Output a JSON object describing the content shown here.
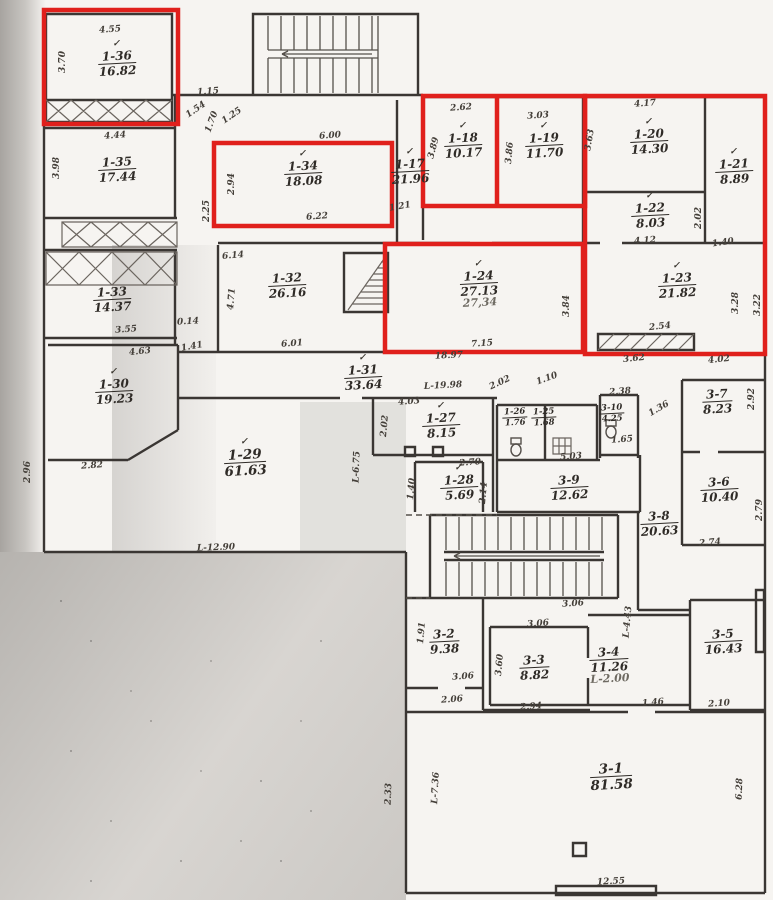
{
  "plan": {
    "highlight_color": "#e0201c",
    "rooms": [
      {
        "id": "1-36",
        "area": "16.82",
        "check": "✓",
        "note": ""
      },
      {
        "id": "1-35",
        "area": "17.44",
        "check": "",
        "note": ""
      },
      {
        "id": "1-33",
        "area": "14.37",
        "check": "",
        "note": ""
      },
      {
        "id": "1-30",
        "area": "19.23",
        "check": "✓",
        "note": ""
      },
      {
        "id": "1-34",
        "area": "18.08",
        "check": "✓",
        "note": ""
      },
      {
        "id": "1-17",
        "area": "21.96",
        "check": "✓",
        "note": ""
      },
      {
        "id": "1-18",
        "area": "10.17",
        "check": "✓",
        "note": ""
      },
      {
        "id": "1-19",
        "area": "11.70",
        "check": "✓",
        "note": ""
      },
      {
        "id": "1-20",
        "area": "14.30",
        "check": "✓",
        "note": ""
      },
      {
        "id": "1-21",
        "area": "8.89",
        "check": "✓",
        "note": ""
      },
      {
        "id": "1-22",
        "area": "8.03",
        "check": "✓",
        "note": ""
      },
      {
        "id": "1-24",
        "area": "27.13",
        "check": "✓",
        "note": "27,34"
      },
      {
        "id": "1-23",
        "area": "21.82",
        "check": "✓",
        "note": ""
      },
      {
        "id": "1-32",
        "area": "26.16",
        "check": "",
        "note": ""
      },
      {
        "id": "1-31",
        "area": "33.64",
        "check": "✓",
        "note": ""
      },
      {
        "id": "1-29",
        "area": "61.63",
        "check": "✓",
        "note": ""
      },
      {
        "id": "1-27",
        "area": "8.15",
        "check": "✓",
        "note": ""
      },
      {
        "id": "1-28",
        "area": "5.69",
        "check": "✓",
        "note": ""
      },
      {
        "id": "1-26",
        "area": "1.76",
        "check": "",
        "note": ""
      },
      {
        "id": "1-25",
        "area": "1.68",
        "check": "",
        "note": ""
      },
      {
        "id": "3-10",
        "area": "4.25",
        "check": "",
        "note": ""
      },
      {
        "id": "3-9",
        "area": "12.62",
        "check": "",
        "note": ""
      },
      {
        "id": "3-7",
        "area": "8.23",
        "check": "",
        "note": ""
      },
      {
        "id": "3-6",
        "area": "10.40",
        "check": "",
        "note": ""
      },
      {
        "id": "3-8",
        "area": "20.63",
        "check": "",
        "note": ""
      },
      {
        "id": "3-2",
        "area": "9.38",
        "check": "",
        "note": ""
      },
      {
        "id": "3-3",
        "area": "8.82",
        "check": "",
        "note": ""
      },
      {
        "id": "3-4",
        "area": "11.26",
        "check": "",
        "note": "L-2.00"
      },
      {
        "id": "3-5",
        "area": "16.43",
        "check": "",
        "note": ""
      },
      {
        "id": "3-1",
        "area": "81.58",
        "check": "",
        "note": ""
      }
    ],
    "dims": [
      "4.55",
      "3.70",
      "1.15",
      "1.54",
      "4.44",
      "3.98",
      "6.00",
      "2.94",
      "2.25",
      "6.22",
      "1.21",
      "2.62",
      "3.89",
      "3.03",
      "3.86",
      "3.63",
      "4.17",
      "2.02",
      "4.12",
      "1.40",
      "7.15",
      "3.84",
      "2.54",
      "3.28",
      "3.62",
      "4.02",
      "3.22",
      "6.14",
      "4.71",
      "6.01",
      "18.97",
      "L-19.98",
      "0.14",
      "1.41",
      "3.55",
      "4.63",
      "2.82",
      "2.96",
      "L-12.90",
      "4.03",
      "2.02",
      "2.70",
      "1.40",
      "2.14",
      "2.02",
      "1.10",
      "2.38",
      "1.65",
      "1.36",
      "5.03",
      "2.92",
      "2.79",
      "2.74",
      "3.06",
      "3.60",
      "2.94",
      "3.06",
      "2.06",
      "1.91",
      "L-4.43",
      "3.06",
      "1.46",
      "2.10",
      "L-7.36",
      "2.33",
      "12.55",
      "6.28",
      "L-6.75",
      "1.25",
      "1.70"
    ]
  }
}
